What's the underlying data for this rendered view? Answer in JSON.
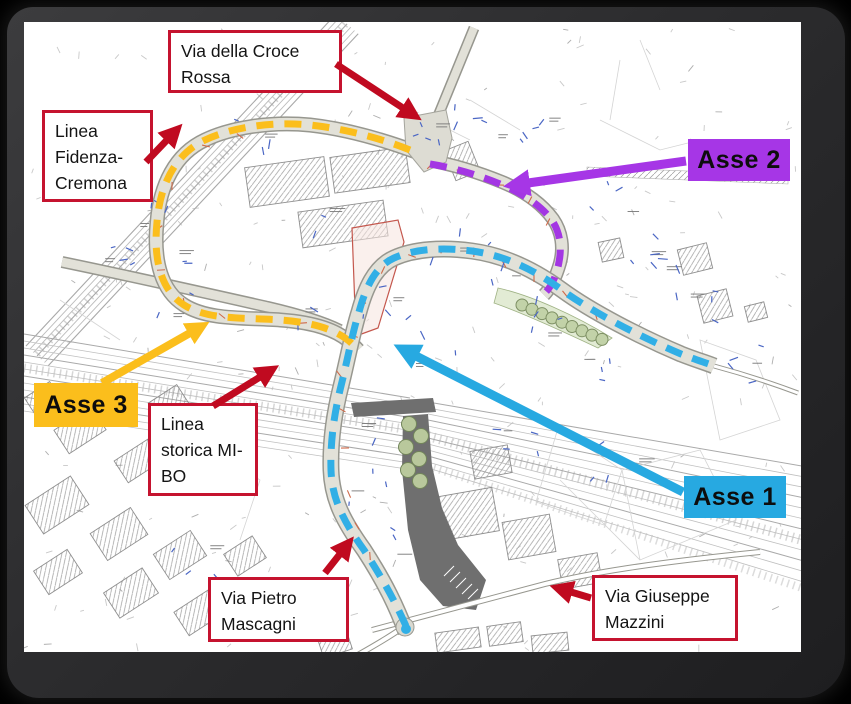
{
  "callouts": [
    {
      "id": "via-della-croce-rossa",
      "text": "Via della Croce Rossa"
    },
    {
      "id": "linea-fidenza-cremona",
      "text": "Linea Fidenza-Cremona"
    },
    {
      "id": "linea-storica-mi-bo",
      "text": "Linea storica MI-BO"
    },
    {
      "id": "via-pietro-mascagni",
      "text": "Via Pietro Mascagni"
    },
    {
      "id": "via-giuseppe-mazzini",
      "text": "Via Giuseppe Mazzini"
    }
  ],
  "axes": [
    {
      "id": "asse-1",
      "label": "Asse 1",
      "color": "#27A9E1"
    },
    {
      "id": "asse-2",
      "label": "Asse 2",
      "color": "#A636E6"
    },
    {
      "id": "asse-3",
      "label": "Asse 3",
      "color": "#FBBE1C"
    }
  ],
  "colors": {
    "callout_border": "#C5132F",
    "arrow_red": "#C00A20",
    "route_cyan": "#31AFE6",
    "route_purple": "#A336E3",
    "route_yellow": "#FBBE1C",
    "map_background": "#FFFFFF",
    "frame": "#2C2C2E",
    "page_background": "#000000"
  }
}
